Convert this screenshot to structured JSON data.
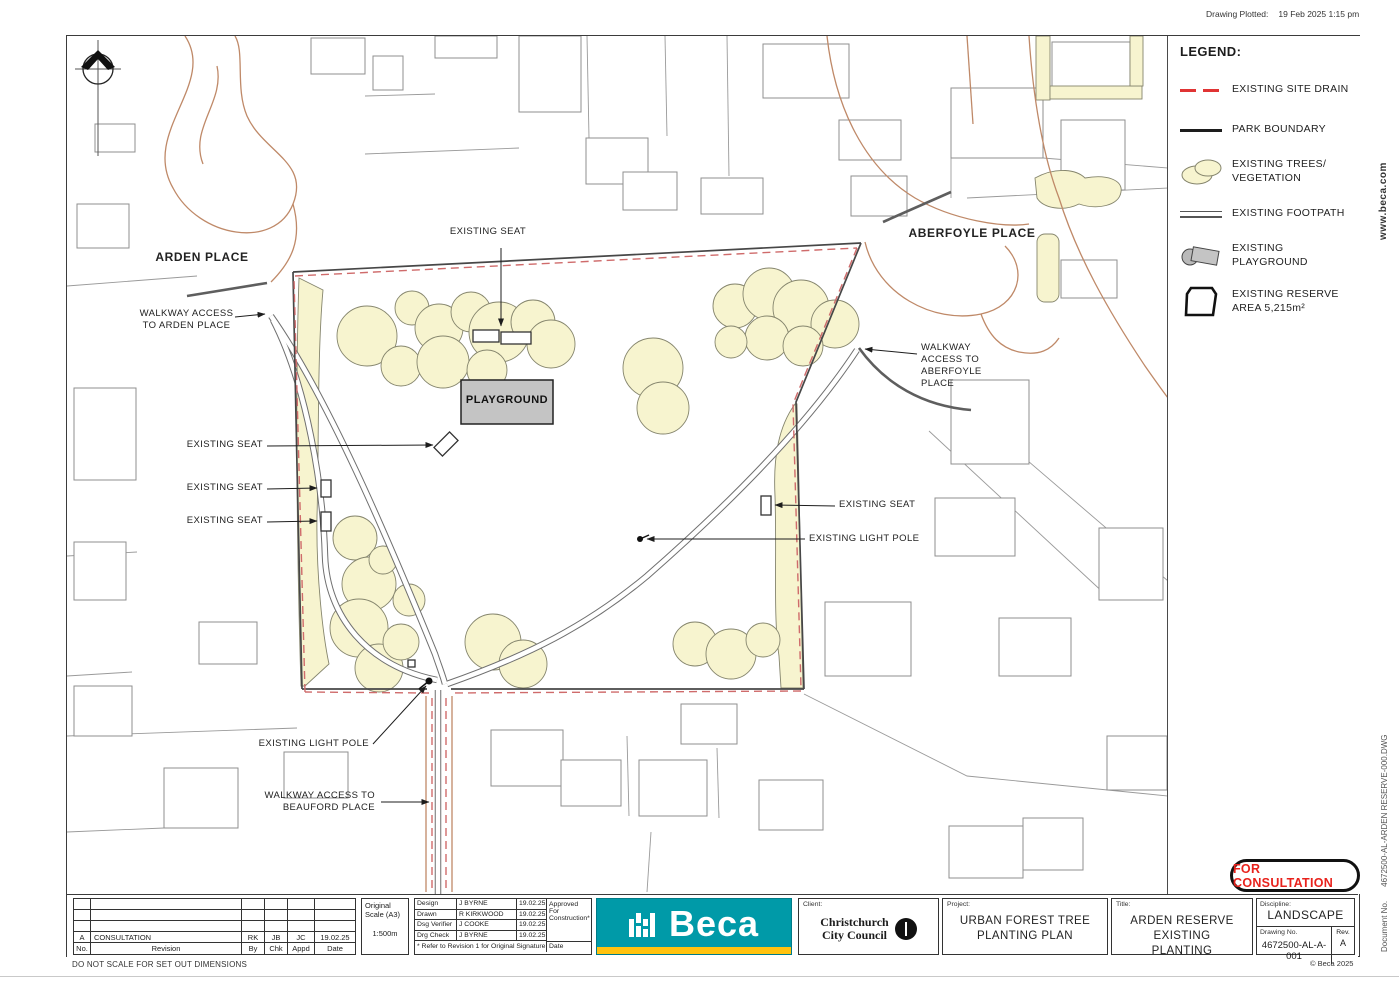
{
  "meta": {
    "plotted_label": "Drawing Plotted:",
    "plotted_value": "19 Feb 2025   1:15 pm"
  },
  "side": {
    "website": "www.beca.com",
    "document_label": "Document No.",
    "document_value": "4672500-AL-ARDEN RESERVE-000.DWG"
  },
  "legend": {
    "title": "LEGEND:",
    "items": [
      {
        "label": "EXISTING SITE DRAIN"
      },
      {
        "label": "PARK BOUNDARY"
      },
      {
        "label": "EXISTING TREES/ VEGETATION"
      },
      {
        "label": "EXISTING FOOTPATH"
      },
      {
        "label": "EXISTING PLAYGROUND"
      },
      {
        "label": "EXISTING RESERVE AREA 5,215m²"
      }
    ]
  },
  "map": {
    "labels": {
      "arden_place": "ARDEN PLACE",
      "aberfoyle_place": "ABERFOYLE PLACE",
      "playground": "PLAYGROUND",
      "existing_seat": "EXISTING SEAT",
      "existing_light_pole": "EXISTING LIGHT POLE",
      "walkway_arden": "WALKWAY ACCESS TO ARDEN PLACE",
      "walkway_aberfoyle": "WALKWAY ACCESS TO ABERFOYLE PLACE",
      "walkway_beauford": "WALKWAY ACCESS TO BEAUFORD PLACE"
    }
  },
  "titleblock": {
    "revision": {
      "headers": {
        "no": "No.",
        "revision": "Revision",
        "by": "By",
        "chk": "Chk",
        "appd": "Appd",
        "date": "Date"
      },
      "row_a": {
        "no": "A",
        "revision": "CONSULTATION",
        "by": "RK",
        "chk": "JB",
        "appd": "JC",
        "date": "19.02.25"
      }
    },
    "note": "DO NOT SCALE FOR SET OUT DIMENSIONS",
    "scale": {
      "label": "Original Scale (A3)",
      "value": "1:500m"
    },
    "design": {
      "rows": [
        {
          "label": "Design",
          "name": "J BYRNE",
          "date": "19.02.25"
        },
        {
          "label": "Drawn",
          "name": "R KIRKWOOD",
          "date": "19.02.25"
        },
        {
          "label": "Dsg Verifier",
          "name": "J COOKE",
          "date": "19.02.25"
        },
        {
          "label": "Drg Check",
          "name": "J BYRNE",
          "date": "19.02.25"
        }
      ],
      "approved": "Approved For Construction*",
      "date_label": "Date",
      "footnote": "* Refer to Revision 1 for Original Signature"
    },
    "beca": "Beca",
    "client": {
      "label": "Client:",
      "name_line1": "Christchurch",
      "name_line2": "City Council"
    },
    "project": {
      "label": "Project:",
      "name": "URBAN FOREST TREE PLANTING PLAN"
    },
    "title": {
      "label": "Title:",
      "name": "ARDEN RESERVE EXISTING PLANTING"
    },
    "discipline": {
      "label": "Discipline:",
      "value": "LANDSCAPE"
    },
    "drawing_no": {
      "label": "Drawing No.",
      "value": "4672500-AL-A-001"
    },
    "rev": {
      "label": "Rev.",
      "value": "A"
    },
    "copyright": "© Beca 2025",
    "badge": "FOR CONSULTATION"
  },
  "colors": {
    "beca_teal": "#009aa8",
    "beca_yellow": "#ffc20e",
    "drain_red": "#e03434",
    "vegetation_fill": "#f7f4cf",
    "consultation_red": "#e8221c",
    "road_tan": "#bf8968"
  }
}
